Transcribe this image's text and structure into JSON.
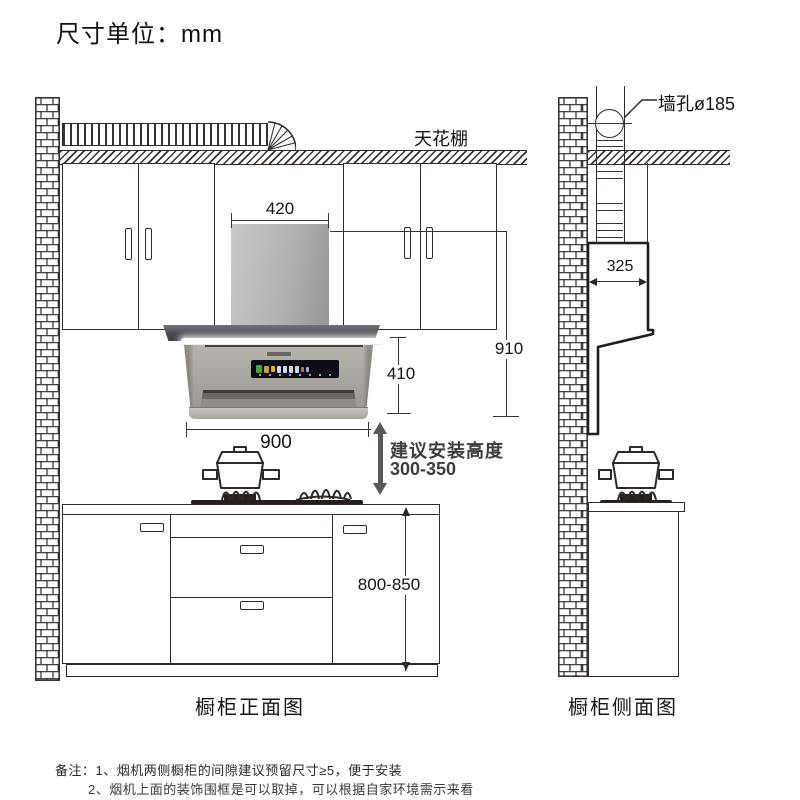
{
  "title": "尺寸单位：mm",
  "front_view": {
    "caption": "橱柜正面图",
    "ceiling_label": "天花棚",
    "dimensions": {
      "chimney_width": "420",
      "overall_height": "910",
      "hood_height": "410",
      "hood_width": "900",
      "counter_height": "800-850",
      "install_height_label": "建议安装高度",
      "install_height_value": "300-350"
    }
  },
  "side_view": {
    "caption": "橱柜侧面图",
    "wall_hole_label": "墙孔ø185",
    "chimney_depth": "325"
  },
  "notes": {
    "line1": "备注：1、烟机两侧橱柜的间隙建议预留尺寸≥5，便于安装",
    "line2": "2、烟机上面的装饰围框是可以取掉，可以根据自家环境需示来看"
  },
  "colors": {
    "line": "#2f2a27",
    "hood_body": "#a9a59f",
    "hood_canopy": "#4a4a52",
    "display_bg": "#0d0d15",
    "arrow_gray": "#57585a"
  }
}
